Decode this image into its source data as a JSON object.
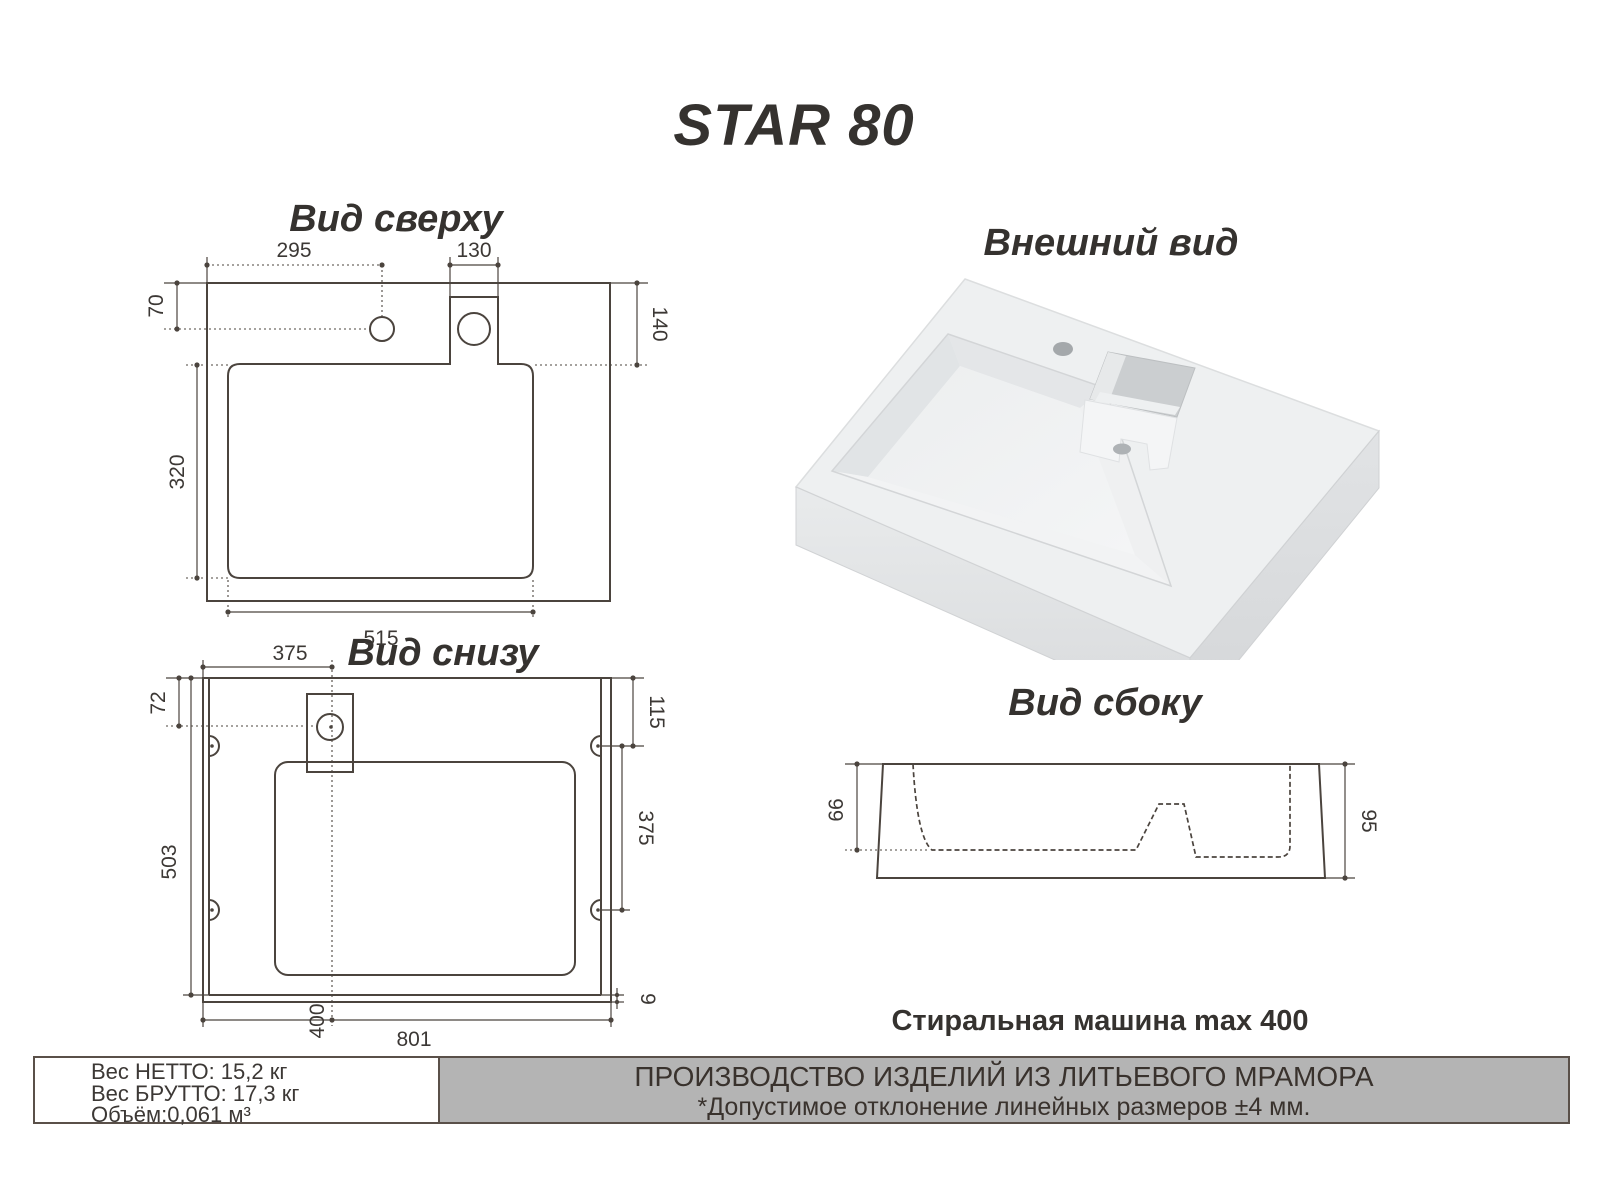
{
  "main_title": "STAR 80",
  "top_view": {
    "title": "Вид сверху",
    "d295": "295",
    "d130": "130",
    "d70": "70",
    "d140": "140",
    "d320": "320",
    "d515": "515"
  },
  "external_view": {
    "title": "Внешний вид"
  },
  "bottom_view": {
    "title": "Вид снизу",
    "d375_top": "375",
    "d72": "72",
    "d503": "503",
    "d115": "115",
    "d375_right": "375",
    "d9": "9",
    "d400": "400",
    "d801": "801"
  },
  "side_view": {
    "title": "Вид сбоку",
    "d66": "66",
    "d95": "95"
  },
  "washer_note": "Стиральная машина max 400",
  "spec_box": {
    "net": "Вес НЕТТО: 15,2 кг",
    "gross": "Вес БРУТТО: 17,3 кг",
    "volume": "Объём:0,061 м³"
  },
  "production_box": {
    "line1": "ПРОИЗВОДСТВО ИЗДЕЛИЙ ИЗ ЛИТЬЕВОГО МРАМОРА",
    "line2": "*Допустимое отклонение линейных размеров ±4 мм."
  },
  "colors": {
    "line": "#4b443e",
    "panel_gray": "#b4b4b4",
    "border_dark": "#5a5049",
    "sink_body": "#eef0f1"
  }
}
